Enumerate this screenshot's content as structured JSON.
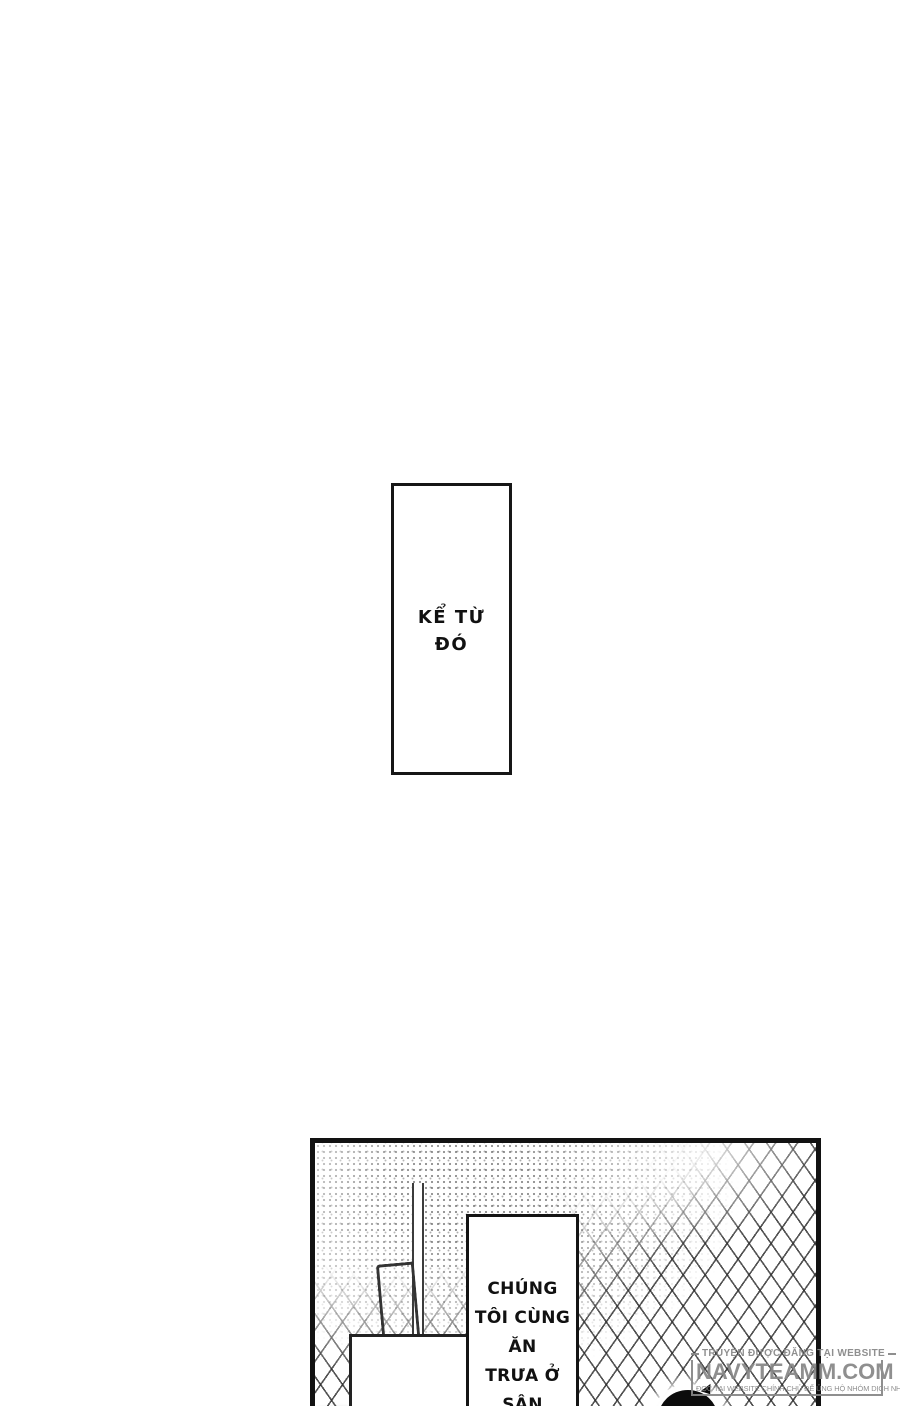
{
  "panel1": {
    "line1": "KỂ TỪ",
    "line2": "ĐÓ"
  },
  "panel2": {
    "caption_lines": [
      "CHÚNG",
      "TÔI CÙNG ĂN",
      "TRƯA Ở SÂN",
      "THƯỢNG."
    ]
  },
  "watermark": {
    "line1": "TRUYỆN ĐƯỢC ĐĂNG TẠI WEBSITE",
    "site": "NAVYTEAMM.COM",
    "line3": "ĐỌC TẠI WEBSITE CHÍNH CHỦ ĐỂ ỦNG HỘ NHÓM DỊCH NHÉ!"
  },
  "colors": {
    "ink": "#141414",
    "fence_line": "#2c2c2c",
    "watermark_gray": "#878787",
    "page_bg": "#ffffff"
  }
}
